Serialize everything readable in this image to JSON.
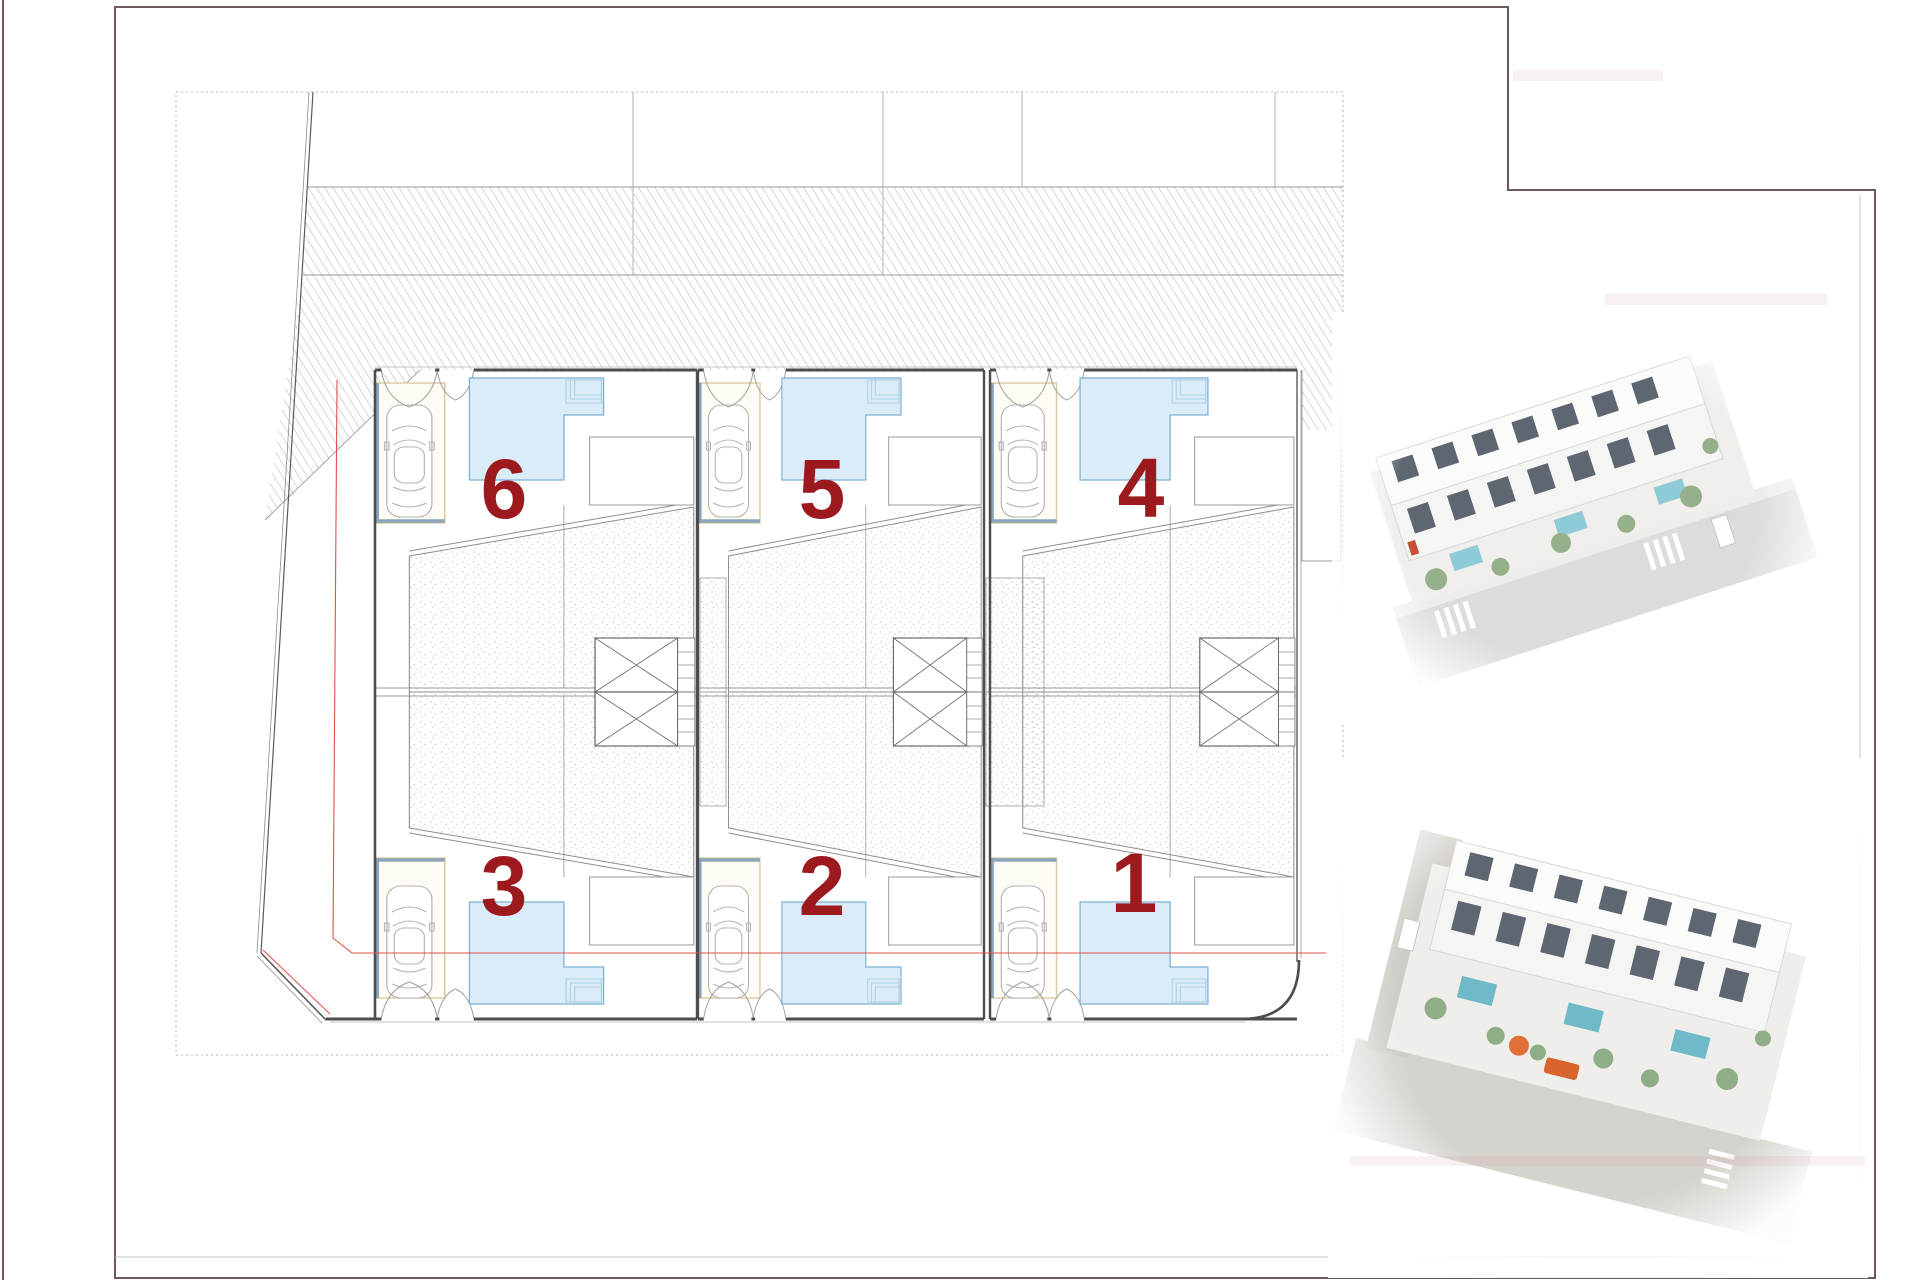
{
  "document": {
    "kind": "architectural site plan, ground floor of 6 semi-detached villas",
    "sheet_background": "#ffffff"
  },
  "colors": {
    "unit_number_red": "#9c1a1e",
    "page_border_maroon": "#6d585a",
    "wall_dark": "#4f4c4c",
    "line_grey": "#9a9a9a",
    "pool_fill": "#d9ecf8",
    "pool_edge": "#7db0d5",
    "pool_steps": "#a8cce2",
    "parking_trim_cream": "#dcc9a0",
    "threshold_blue": "#8ba6ba",
    "setback_red_line": "#e05048",
    "hatch_grey": "#d0d0d0",
    "stipple_grey": "#c2c2c2"
  },
  "plan": {
    "units": [
      {
        "label": "6",
        "row": "top"
      },
      {
        "label": "5",
        "row": "top"
      },
      {
        "label": "4",
        "row": "top"
      },
      {
        "label": "3",
        "row": "bottom"
      },
      {
        "label": "2",
        "row": "bottom"
      },
      {
        "label": "1",
        "row": "bottom"
      }
    ],
    "icons_per_unit": [
      "car-icon",
      "entry-arch-icon",
      "pool-icon",
      "elevator-x-box-icon",
      "stair-icon"
    ],
    "site_marks": [
      "dotted-site-boundary",
      "hatched-roof-bands",
      "red-setback-line",
      "chamfered-corner"
    ]
  },
  "renders": [
    {
      "name": "aerial-3d-render-street-side"
    },
    {
      "name": "aerial-3d-render-garden-side"
    }
  ]
}
